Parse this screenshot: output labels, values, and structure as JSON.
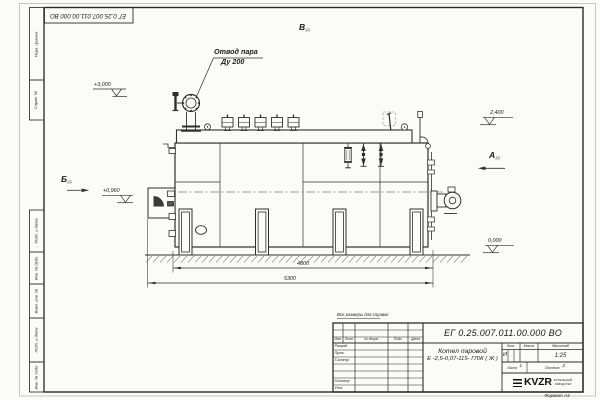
{
  "sheet": {
    "format_label": "Формат А3",
    "reference_note": "Все размеры для справок"
  },
  "margin_stamps": [
    "Перв. примен.",
    "Справ. №",
    "Подп. и дата",
    "Инв. № дубл.",
    "Взам. инв. №",
    "Подп. и дата",
    "Инв. № подл."
  ],
  "title_block": {
    "designation": "ЕГ 0.25.007.011.00.000  ВО",
    "product_name_line1": "Котел паровой",
    "product_name_line2": "Е -2,5-0,07-115- ГЛЖ ( Ж )",
    "rev_headers": {
      "izm": "Изм.",
      "list": "Лист",
      "doc": "№ докум.",
      "sign": "Подп.",
      "date": "Дата"
    },
    "row_labels": {
      "developed": "Разраб.",
      "checked": "Пров.",
      "tcontrol": "Т.контр.",
      "ncontrol": "Н.контр.",
      "approved": "Утв."
    },
    "lit_header": "Лит.",
    "mass_header": "Масса",
    "scale_header": "Масштаб",
    "lit_value": "И",
    "scale_value": "1:25",
    "sheet_label": "Лист",
    "sheet_value": "1",
    "sheets_label": "Листов",
    "sheets_value": "2",
    "logo_text": "KVZR",
    "logo_caption_line1": "КОТЕЛЬНЫЙ",
    "logo_caption_line2": "ЗАВОД РЭП"
  },
  "drawing": {
    "callout_line1": "Отвод пара",
    "callout_line2": "Ду 200",
    "view_top": {
      "label": "В",
      "sub": "(2)"
    },
    "view_a": {
      "label": "А",
      "sub": "(2)"
    },
    "view_b": {
      "label": "Б",
      "sub": "(2)"
    },
    "elev_3000": "+3,000",
    "elev_2400": "2,400",
    "elev_0960": "+0,960",
    "elev_0000": "0,000",
    "dim_4800": "4800",
    "dim_5300": "5300"
  }
}
